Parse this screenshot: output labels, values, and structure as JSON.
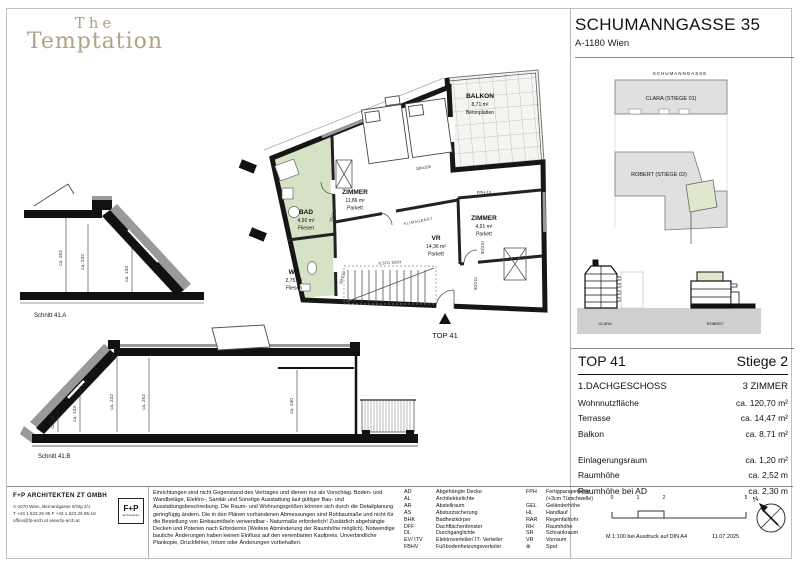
{
  "logo": {
    "line1": "The",
    "line2": "Temptation"
  },
  "header": {
    "title": "SCHUMANNGASSE 35",
    "subtitle": "A-1180 Wien"
  },
  "site_plan": {
    "street": "SCHUMANNGASSE",
    "building_top": "CLARA (STIEGE 01)",
    "building_bottom": "ROBERT (STIEGE 02)",
    "elev_left": "CLARA",
    "elev_right": "ROBERT"
  },
  "floor_plan": {
    "rooms": [
      {
        "name": "BALKON",
        "area": "8,71 m²",
        "floor": "Betonplatten"
      },
      {
        "name": "ZIMMER",
        "area": "11,86 m²",
        "floor": "Parkett"
      },
      {
        "name": "BAD",
        "area": "4,90 m²",
        "floor": "Fliesen"
      },
      {
        "name": "WC",
        "area": "2,75 m²",
        "floor": "Fliesen"
      },
      {
        "name": "VR",
        "area": "14,36 m²",
        "floor": "Parkett"
      },
      {
        "name": "ZIMMER",
        "area": "4,91 m²",
        "floor": "Parkett"
      }
    ],
    "labels": {
      "top": "TOP 41",
      "bed": "180x200",
      "klima": "KLIMAGERÄT",
      "fph": "FPH-10",
      "rar": "RAR Ø",
      "stair": "8 STG 19/24",
      "door_bad": "80/210",
      "door_entry": "90/210",
      "door_zimmer": "80/210",
      "door_wc": "60/210"
    }
  },
  "sections": [
    {
      "caption": "Schnitt 41.A",
      "dims": [
        "ca. 252",
        "ca. 232",
        "ca. 133"
      ]
    },
    {
      "caption": "Schnitt 41.B",
      "dims": [
        "ca. 60",
        "ca. 133",
        "ca. 232",
        "ca. 252",
        "ca. 230"
      ]
    }
  ],
  "info_panel": {
    "unit": "TOP 41",
    "stiege": "Stiege 2",
    "floor": "1.DACHGESCHOSS",
    "rooms": "3 ZIMMER",
    "rows": [
      {
        "label": "Wohnnutzfläche",
        "value": "ca. 120,70 m²"
      },
      {
        "label": "Terrasse",
        "value": "ca. 14,47 m²"
      },
      {
        "label": "Balkon",
        "value": "ca. 8,71 m²"
      }
    ],
    "rows2": [
      {
        "label": "Einlagerungsraum",
        "value": "ca. 1,20 m²"
      },
      {
        "label": "Raumhöhe",
        "value": "ca. 2,52 m"
      },
      {
        "label": "Raumhöhe bei AD",
        "value": "ca. 2,30 m"
      }
    ]
  },
  "footer": {
    "firm": {
      "name": "F+P ARCHITEKTEN ZT GMBH",
      "address": "A-1070 Wien, Bernardgasse 8/Stg 2/1",
      "phone": "T +43 1 523 26 95   F +43 1 523 26 95-18",
      "web": "office@fp-arch.at    www.fp-arch.at",
      "logo_main": "F+P",
      "logo_sub": "architekten"
    },
    "disclaimer": "Einrichtungen sind nicht Gegenstand des Vertrages und dienen nur als Vorschlag. Boden- und Wandbeläge, Elektro-, Sanitär und Sonstige Ausstattung laut gültiger Bau- und Ausstattungsbeschreibung. Die Raum- und Wohnungsgrößen können sich durch die Detailplanung geringfügig ändern. Die in den Plänen vorhandenen Abmessungen sind Rohbaumaße und nicht für die Bestellung von Einbaumöbeln verwendbar - Naturmaße erforderlich! Zusätzlich abgehängte Decken und Poterien nach Erfordernis (Weitere Abminderung der Raumhöhe möglich). Notwendige bauliche Änderungen haben keinen Einfluss auf den vereinbarten Kaufpreis. Unverbindliche Plankopie, Druckfehler, Irrtum oder Änderungen vorbehalten.",
    "legend1": [
      {
        "abbr": "AD",
        "desc": "Abgehängte Decke"
      },
      {
        "abbr": "AL",
        "desc": "Architekturlichte"
      },
      {
        "abbr": "AR",
        "desc": "Abstellraum"
      },
      {
        "abbr": "AS",
        "desc": "Absturzsicherung"
      },
      {
        "abbr": "BHK",
        "desc": "Badheizkörper"
      },
      {
        "abbr": "DFF",
        "desc": "Dachflächenfenster"
      },
      {
        "abbr": "DL",
        "desc": "Durchganglichte"
      },
      {
        "abbr": "EV/ ITV",
        "desc": "Elektroverteiler/ IT- Verteiler"
      },
      {
        "abbr": "FBHV",
        "desc": "Fußbodenheizungsverteiler"
      }
    ],
    "legend2": [
      {
        "abbr": "FPH",
        "desc": "Fertigparapethöhe\n(+3cm Türschwelle)"
      },
      {
        "abbr": "GEL",
        "desc": "Geländerhöhe"
      },
      {
        "abbr": "HL",
        "desc": "Handlauf"
      },
      {
        "abbr": "RAR",
        "desc": "Regenfallrohr"
      },
      {
        "abbr": "RH",
        "desc": "Raumhöhe"
      },
      {
        "abbr": "SR",
        "desc": "Schrankraum"
      },
      {
        "abbr": "VR",
        "desc": "Vorraum"
      },
      {
        "abbr": "⊗",
        "desc": "Spot"
      }
    ],
    "scale": {
      "ticks": [
        "0",
        "1",
        "2",
        "5"
      ],
      "note": "M 1:100 bei Ausdruck auf DIN A4",
      "date": "11.07.2025"
    },
    "north": "N"
  },
  "colors": {
    "accent_green": "#d6e2c6",
    "site_green": "#dfe8cd",
    "logo_gold": "#b2a183",
    "wall": "#161616"
  }
}
